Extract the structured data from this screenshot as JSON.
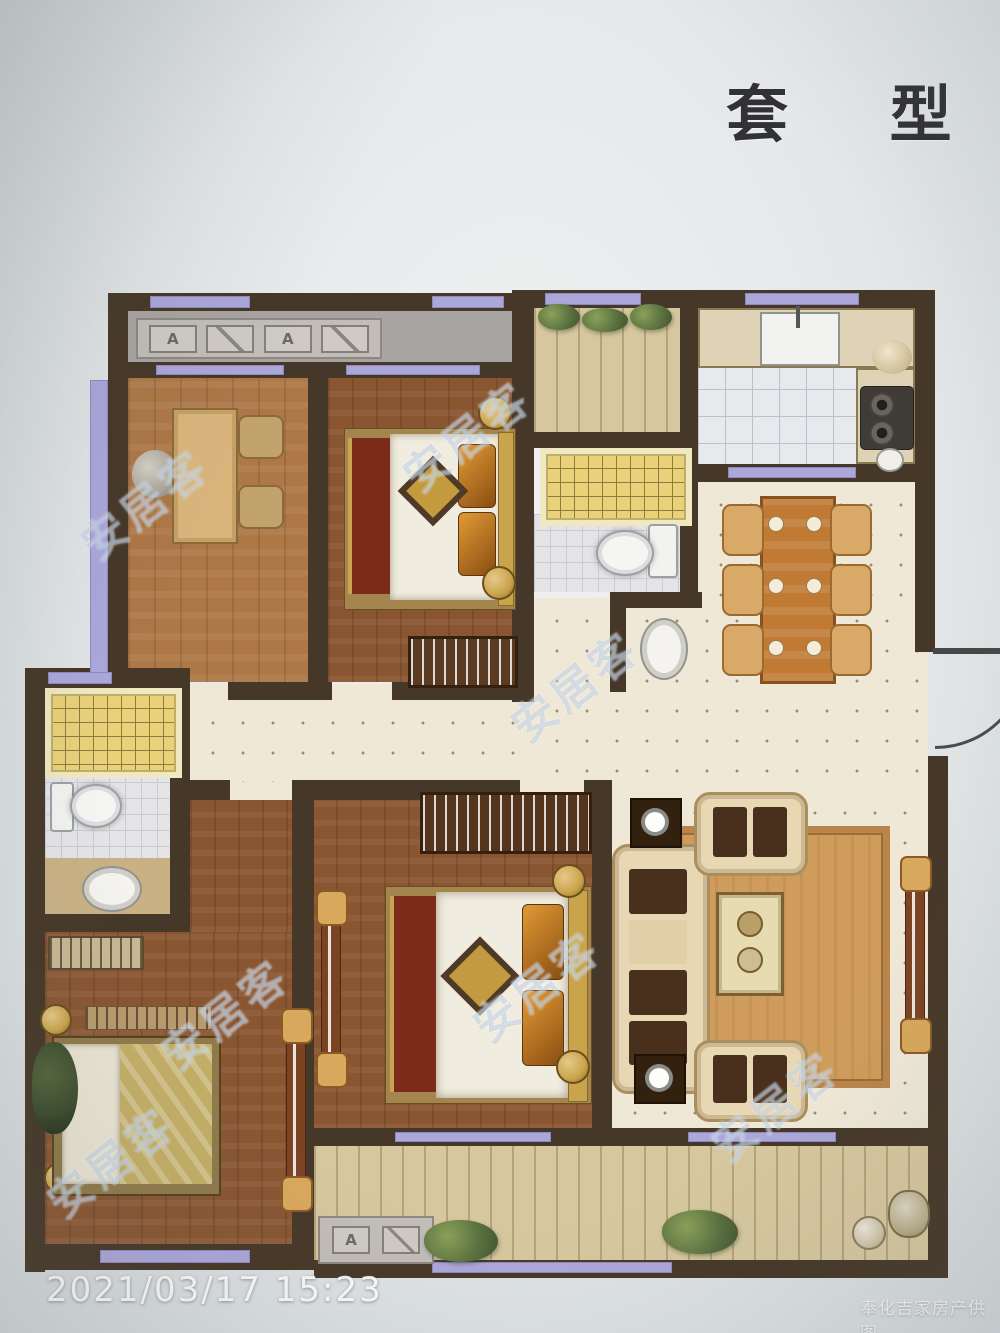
{
  "page": {
    "title": "套 型",
    "timestamp": "2021/03/17 15:23",
    "provider_watermark": "奉化吉家房产供图",
    "diagonal_watermark": "安居客"
  },
  "plan": {
    "ac_platform_top": {
      "unit1_label": "A",
      "unit2_label": "A"
    },
    "ac_platform_bottom": {
      "label": "A"
    },
    "colors": {
      "wall": "#463828",
      "window": "#aba7d9",
      "wood_light": "#ad7746",
      "wood_dark": "#8a5632",
      "kitchen_tile": "#e7e9ed",
      "bath_tile": "#e4e4e7",
      "shower": "#e8d178",
      "cream_floor": "#efe8d7",
      "balcony_plank": "#d6c79e",
      "ac_balcony_gray": "#a8a4a1",
      "rug": "#cf9c5b",
      "sofa": "#e8d7b3",
      "cushion": "#49301d",
      "pillow": "#c87f22",
      "bed_runner": "#7c2a1a",
      "gold_trim": "#c9a44c",
      "dining_wood": "#c07a34"
    }
  }
}
